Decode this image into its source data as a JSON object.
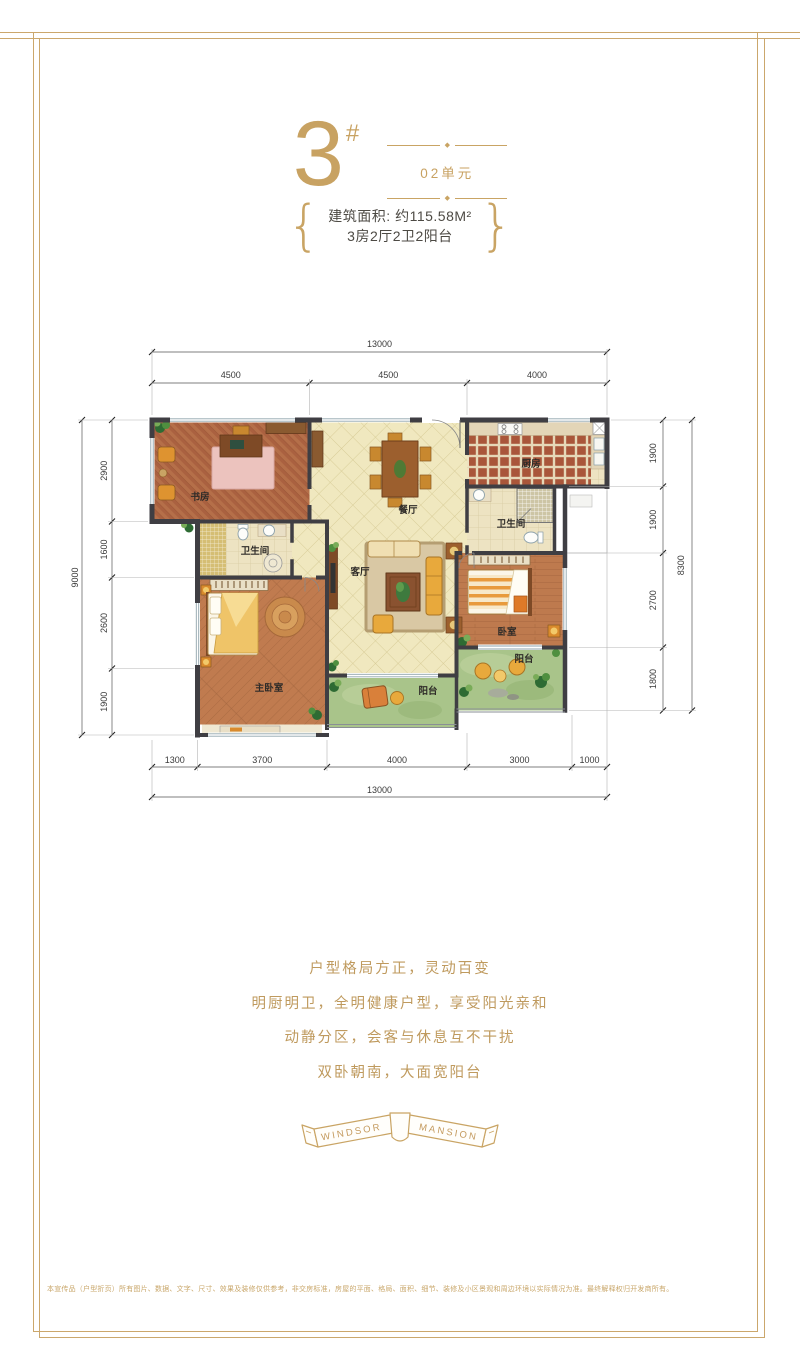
{
  "colors": {
    "accent_gold": "#C8A262",
    "frame_gold": "#CBA76C",
    "wall": "#3F3E43",
    "tile_cream": "#F0E8BF",
    "wood_brown": "#BE7A4E",
    "balcony_green": "#A9C48A"
  },
  "header": {
    "block_number": "3",
    "hash": "#",
    "ornament": "◆",
    "unit": "02单元",
    "brace_left": "{",
    "brace_right": "}",
    "area": "建筑面积: 约115.58M²",
    "layout": "3房2厅2卫2阳台"
  },
  "plan": {
    "rooms": {
      "study": "书房",
      "dining": "餐厅",
      "kitchen": "厨房",
      "bath1": "卫生间",
      "bath2": "卫生间",
      "living": "客厅",
      "master": "主卧室",
      "bedroom": "卧室",
      "balcony1": "阳台",
      "balcony2": "阳台"
    },
    "dims": {
      "top_total": "13000",
      "top": [
        "4500",
        "4500",
        "4000"
      ],
      "left_total": "9000",
      "left": [
        "2900",
        "1600",
        "2600",
        "1900"
      ],
      "right_total": "8300",
      "right": [
        "1900",
        "1900",
        "2700",
        "1800"
      ],
      "bottom": [
        "1300",
        "3700",
        "4000",
        "3000",
        "1000"
      ],
      "bottom_total": "13000"
    }
  },
  "marketing": {
    "lines": [
      "户型格局方正，灵动百变",
      "明厨明卫，全明健康户型，享受阳光亲和",
      "动静分区，会客与休息互不干扰",
      "双卧朝南，大面宽阳台"
    ]
  },
  "brand": {
    "left": "WINDSOR",
    "right": "MANSION"
  },
  "footer": {
    "disclaimer": "本宣传品（户型折页）所有图片、数据、文字、尺寸、效果及装修仅供参考，非交房标准，房屋的平面、格局、面积、细节、装修及小区景观和周边环境以实际情况为准。最终解释权归开发商所有。"
  }
}
